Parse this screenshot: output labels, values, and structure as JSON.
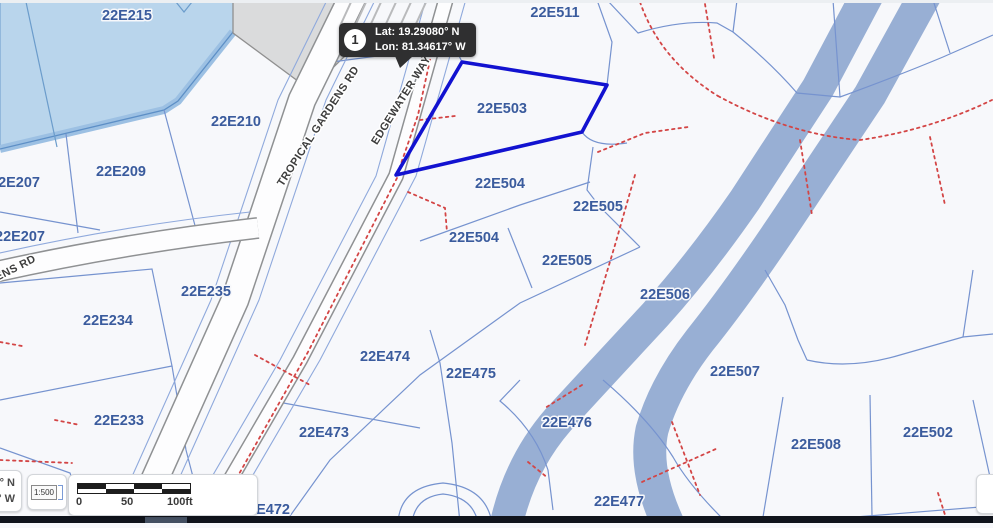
{
  "map": {
    "selected_parcel": "22E503",
    "callout": {
      "number": "1",
      "lat_label": "Lat: 19.29080° N",
      "lon_label": "Lon: 81.34617° W"
    },
    "coordinate_readout": {
      "line1": "° N",
      "line2": "° W"
    },
    "scale_select": {
      "value": "1:500"
    },
    "scale_bar": {
      "ticks": [
        "0",
        "50",
        "100ft"
      ]
    },
    "parcel_labels": [
      {
        "text": "22E215",
        "x": 127,
        "y": 20
      },
      {
        "text": "22E511",
        "x": 555,
        "y": 17
      },
      {
        "text": "22E210",
        "x": 236,
        "y": 126
      },
      {
        "text": "22E209",
        "x": 121,
        "y": 176
      },
      {
        "text": "22E207",
        "x": 15,
        "y": 187
      },
      {
        "text": "22E207",
        "x": 20,
        "y": 241
      },
      {
        "text": "22E503",
        "x": 502,
        "y": 113
      },
      {
        "text": "22E504",
        "x": 500,
        "y": 188
      },
      {
        "text": "22E505",
        "x": 598,
        "y": 211
      },
      {
        "text": "22E504",
        "x": 474,
        "y": 242
      },
      {
        "text": "22E505",
        "x": 567,
        "y": 265
      },
      {
        "text": "22E506",
        "x": 665,
        "y": 299
      },
      {
        "text": "22E235",
        "x": 206,
        "y": 296
      },
      {
        "text": "22E234",
        "x": 108,
        "y": 325
      },
      {
        "text": "22E474",
        "x": 385,
        "y": 361
      },
      {
        "text": "22E475",
        "x": 471,
        "y": 378
      },
      {
        "text": "22E507",
        "x": 735,
        "y": 376
      },
      {
        "text": "22E233",
        "x": 119,
        "y": 425
      },
      {
        "text": "22E473",
        "x": 324,
        "y": 437
      },
      {
        "text": "22E476",
        "x": 567,
        "y": 427
      },
      {
        "text": "22E502",
        "x": 928,
        "y": 437
      },
      {
        "text": "22E508",
        "x": 816,
        "y": 449
      },
      {
        "text": "22E477",
        "x": 619,
        "y": 506
      },
      {
        "text": "22E472",
        "x": 265,
        "y": 514
      }
    ],
    "road_labels": [
      {
        "text": "TROPICAL GARDENS RD",
        "x": 321,
        "y": 128,
        "rotation": -57
      },
      {
        "text": "EDGEWATER WAY",
        "x": 404,
        "y": 102,
        "rotation": -58
      },
      {
        "text": "ENS RD",
        "x": 17,
        "y": 271,
        "rotation": -27
      }
    ],
    "colors": {
      "parcel_fill": "#f7f8fb",
      "parcel_line": "#7693cf",
      "water": "#b9d5ec",
      "canal": "#98afd4",
      "selected_outline": "#1212d0",
      "easement_red": "#d34545",
      "label_blue": "#3a5b9d",
      "callout_bg": "#2f2f30"
    }
  }
}
